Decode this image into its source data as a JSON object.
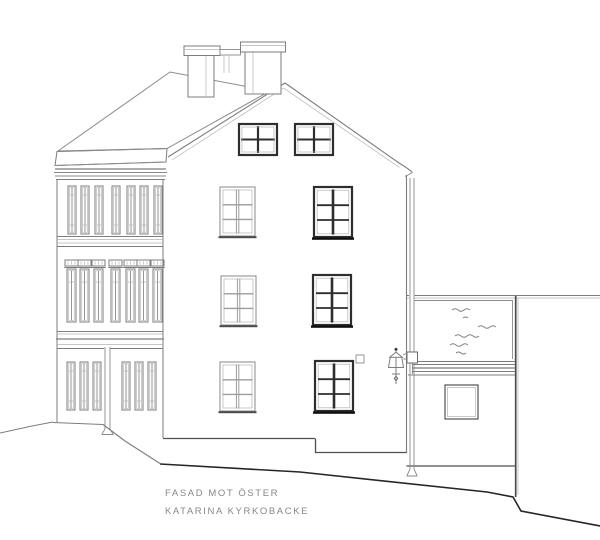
{
  "drawing": {
    "title_lines": {
      "line1": "FASAD MOT ÖSTER",
      "line2": "KATARINA KYRKOBACKE"
    },
    "colors": {
      "background": "#ffffff",
      "ink": "#7d7d7d",
      "ink_light": "#b2b2b2",
      "ink_dark": "#2e2e2e"
    }
  }
}
